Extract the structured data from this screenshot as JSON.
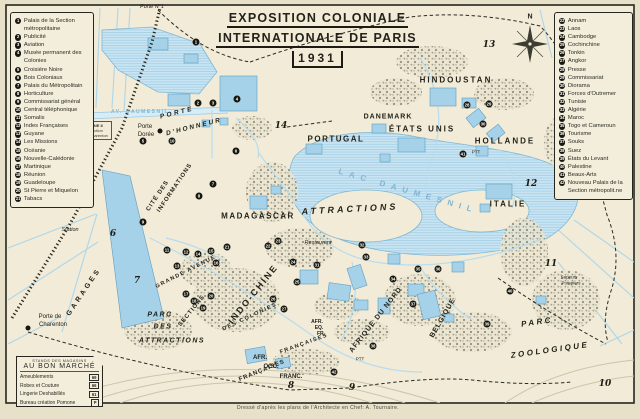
{
  "title": {
    "line1": "EXPOSITION COLONIALE",
    "line2": "INTERNATIONALE DE PARIS",
    "line3": "1931"
  },
  "attribution": "Dressé d'après les plans de l'Architecte en Chef: A. Tournaire.",
  "colors": {
    "paper": "#f1ebd7",
    "water": "#c9e4f2",
    "building": "#a5d1e9",
    "ink": "#23231c"
  },
  "legend_left": {
    "items": [
      {
        "num": "1",
        "label": "Palais de la Section métropolitaine"
      },
      {
        "num": "2",
        "label": "Publicité"
      },
      {
        "num": "3",
        "label": "Aviation"
      },
      {
        "num": "4",
        "label": "Musée permanent des Colonies"
      },
      {
        "num": "5",
        "label": "Croisière Noire"
      },
      {
        "num": "6",
        "label": "Bois Coloniaux"
      },
      {
        "num": "7",
        "label": "Palais du Métropolitain"
      },
      {
        "num": "8",
        "label": "Horticulture"
      },
      {
        "num": "9",
        "label": "Commissariat général"
      },
      {
        "num": "10",
        "label": "Central téléphonique"
      },
      {
        "num": "11",
        "label": "Somalis"
      },
      {
        "num": "12",
        "label": "Indes Françaises"
      },
      {
        "num": "13",
        "label": "Guyane"
      },
      {
        "num": "14",
        "label": "Les Missions"
      },
      {
        "num": "15",
        "label": "Océanie"
      },
      {
        "num": "16",
        "label": "Nouvelle-Calédonie"
      },
      {
        "num": "17",
        "label": "Martinique"
      },
      {
        "num": "18",
        "label": "Réunion"
      },
      {
        "num": "19",
        "label": "Guadeloupe"
      },
      {
        "num": "20",
        "label": "St Pierre et Miquelon"
      },
      {
        "num": "21",
        "label": "Tabacs"
      }
    ]
  },
  "legend_right": {
    "items": [
      {
        "num": "22",
        "label": "Annam"
      },
      {
        "num": "23",
        "label": "Laos"
      },
      {
        "num": "24",
        "label": "Cambodge"
      },
      {
        "num": "25",
        "label": "Cochinchine"
      },
      {
        "num": "26",
        "label": "Tonkin"
      },
      {
        "num": "27",
        "label": "Angkor"
      },
      {
        "num": "28",
        "label": "Presse"
      },
      {
        "num": "29",
        "label": "Commissariat"
      },
      {
        "num": "30",
        "label": "Diorama"
      },
      {
        "num": "31",
        "label": "Forces d'Outremer"
      },
      {
        "num": "32",
        "label": "Tunisie"
      },
      {
        "num": "33",
        "label": "Algérie"
      },
      {
        "num": "34",
        "label": "Maroc"
      },
      {
        "num": "35",
        "label": "Togo et Cameroun"
      },
      {
        "num": "36",
        "label": "Tourisme"
      },
      {
        "num": "37",
        "label": "Souks"
      },
      {
        "num": "38",
        "label": "Suez"
      },
      {
        "num": "39",
        "label": "États du Levant"
      },
      {
        "num": "40",
        "label": "Palestine"
      },
      {
        "num": "41",
        "label": "Beaux-Arts"
      },
      {
        "num": "42",
        "label": "Nouveau Palais de la Section métropolit.ne"
      }
    ]
  },
  "bon_marche": {
    "header_small": "STANDS DES MAGASINS",
    "header": "AU BON MARCHÉ",
    "rows": [
      {
        "label": "Ameublements",
        "badge": "69"
      },
      {
        "label": "Robes et Couture",
        "badge": "66"
      },
      {
        "label": "Lingerie Deshabillés",
        "badge": "61"
      },
      {
        "label": "Bureau création Pomone",
        "badge": "P"
      }
    ]
  },
  "metro_box": {
    "lines": [
      "LIGNE 8",
      "Direction",
      "Pte Charenton"
    ]
  },
  "map_labels": [
    {
      "text": "Porte N°1",
      "x": 152,
      "y": 7,
      "size": 5.5,
      "cls": "it light"
    },
    {
      "text": "AV. DAUMESNIL",
      "x": 140,
      "y": 112,
      "size": 5,
      "ls": 1.5,
      "cls": "blue"
    },
    {
      "text": "PORTE",
      "x": 177,
      "y": 113,
      "rot": -14,
      "size": 6.5,
      "ls": 2.5,
      "cls": "it"
    },
    {
      "text": "D'HONNEUR",
      "x": 194,
      "y": 127,
      "rot": -14,
      "size": 6.5,
      "ls": 2,
      "cls": "it"
    },
    {
      "text": "Porte",
      "x": 145,
      "y": 127,
      "size": 6,
      "cls": "light"
    },
    {
      "text": "Dorée",
      "x": 146,
      "y": 135,
      "size": 6,
      "cls": "light"
    },
    {
      "text": "CITÉ DES",
      "x": 158,
      "y": 196,
      "rot": -56,
      "size": 6,
      "ls": 1
    },
    {
      "text": "INFORMATIONS",
      "x": 175,
      "y": 188,
      "rot": -56,
      "size": 6,
      "ls": 1
    },
    {
      "text": "MADAGASCAR",
      "x": 258,
      "y": 216,
      "size": 8,
      "ls": 1.5
    },
    {
      "text": "PORTUGAL",
      "x": 336,
      "y": 139,
      "size": 8,
      "ls": 1.5
    },
    {
      "text": "DANEMARK",
      "x": 388,
      "y": 117,
      "size": 7,
      "ls": 1
    },
    {
      "text": "ÉTATS UNIS",
      "x": 422,
      "y": 129,
      "size": 8,
      "ls": 2
    },
    {
      "text": "HINDOUSTAN",
      "x": 456,
      "y": 80,
      "size": 8,
      "ls": 2
    },
    {
      "text": "HOLLANDE",
      "x": 505,
      "y": 141,
      "size": 8,
      "ls": 2
    },
    {
      "text": "ITALIE",
      "x": 508,
      "y": 204,
      "size": 8,
      "ls": 2
    },
    {
      "text": "LAC DAUMESNIL",
      "x": 408,
      "y": 191,
      "rot": 16,
      "size": 8,
      "ls": 6,
      "cls": "blue"
    },
    {
      "text": "ATTRACTIONS",
      "x": 350,
      "y": 209,
      "rot": -3,
      "size": 9,
      "ls": 3,
      "cls": "it"
    },
    {
      "text": "Restaurant",
      "x": 318,
      "y": 243,
      "size": 5.5,
      "cls": "it light"
    },
    {
      "text": "GRANDE AVENUE",
      "x": 186,
      "y": 272,
      "rot": -27,
      "size": 5.5,
      "ls": 1.5
    },
    {
      "text": "DES COLONIES",
      "x": 250,
      "y": 317,
      "rot": -25,
      "size": 5.5,
      "ls": 1.5
    },
    {
      "text": "FRANÇAISES",
      "x": 304,
      "y": 344,
      "rot": -20,
      "size": 5.5,
      "ls": 1.5
    },
    {
      "text": "INDO-CHINE",
      "x": 253,
      "y": 294,
      "rot": -51,
      "size": 9,
      "ls": 2
    },
    {
      "text": "SECTIONS",
      "x": 192,
      "y": 311,
      "rot": -51,
      "size": 6,
      "ls": 1
    },
    {
      "text": "PARC",
      "x": 160,
      "y": 315,
      "size": 7,
      "ls": 1.5,
      "cls": "it"
    },
    {
      "text": "DES",
      "x": 163,
      "y": 327,
      "size": 7,
      "ls": 1.5,
      "cls": "it"
    },
    {
      "text": "ATTRACTIONS",
      "x": 172,
      "y": 341,
      "size": 7,
      "ls": 1.5,
      "cls": "it"
    },
    {
      "text": "AFRIQUE DU NORD",
      "x": 376,
      "y": 320,
      "rot": -52,
      "size": 7,
      "ls": 1
    },
    {
      "text": "BELGIQUE",
      "x": 443,
      "y": 318,
      "rot": -60,
      "size": 7,
      "ls": 1
    },
    {
      "text": "PARC",
      "x": 537,
      "y": 322,
      "rot": -8,
      "size": 8,
      "ls": 2.5,
      "cls": "it"
    },
    {
      "text": "ZOOLOGIQUE",
      "x": 550,
      "y": 350,
      "rot": -8,
      "size": 8,
      "ls": 2.5,
      "cls": "it"
    },
    {
      "text": "AFR.",
      "x": 317,
      "y": 322,
      "size": 5
    },
    {
      "text": "EQ.",
      "x": 319,
      "y": 328,
      "size": 5
    },
    {
      "text": "FR.",
      "x": 321,
      "y": 334,
      "size": 5
    },
    {
      "text": "AFR.",
      "x": 260,
      "y": 358,
      "size": 6
    },
    {
      "text": "OCC.",
      "x": 271,
      "y": 367,
      "size": 6
    },
    {
      "text": "FRANC.",
      "x": 291,
      "y": 377,
      "size": 6
    },
    {
      "text": "FRANÇAISES",
      "x": 262,
      "y": 371,
      "rot": -22,
      "size": 6,
      "ls": 1
    },
    {
      "text": "GARAGES",
      "x": 84,
      "y": 292,
      "rot": -56,
      "size": 7,
      "ls": 3
    },
    {
      "text": "Station",
      "x": 70,
      "y": 230,
      "size": 5.5,
      "cls": "it light"
    },
    {
      "text": "Porte de",
      "x": 50,
      "y": 317,
      "size": 6,
      "cls": "light"
    },
    {
      "text": "Charenton",
      "x": 53,
      "y": 325,
      "size": 6,
      "cls": "light"
    },
    {
      "text": "Sapeurs",
      "x": 569,
      "y": 277,
      "size": 4.5,
      "cls": "light"
    },
    {
      "text": "Pompiers",
      "x": 571,
      "y": 283,
      "size": 4.5,
      "cls": "light"
    },
    {
      "text": "PTT",
      "x": 476,
      "y": 152,
      "size": 4.5,
      "cls": "light"
    },
    {
      "text": "PTT",
      "x": 360,
      "y": 359,
      "size": 4.5,
      "cls": "light"
    },
    {
      "text": "N",
      "x": 530,
      "y": 17,
      "size": 7
    },
    {
      "text": "6",
      "x": 113,
      "y": 234,
      "size": 9,
      "cls": "gate"
    },
    {
      "text": "7",
      "x": 137,
      "y": 281,
      "size": 9,
      "cls": "gate"
    },
    {
      "text": "8",
      "x": 291,
      "y": 386,
      "size": 9,
      "cls": "gate"
    },
    {
      "text": "9",
      "x": 352,
      "y": 388,
      "size": 9,
      "cls": "gate"
    },
    {
      "text": "10",
      "x": 605,
      "y": 384,
      "size": 9,
      "cls": "gate"
    },
    {
      "text": "11",
      "x": 551,
      "y": 264,
      "size": 9,
      "cls": "gate"
    },
    {
      "text": "12",
      "x": 531,
      "y": 184,
      "size": 9,
      "cls": "gate"
    },
    {
      "text": "13",
      "x": 489,
      "y": 45,
      "size": 9,
      "cls": "gate"
    },
    {
      "text": "14",
      "x": 281,
      "y": 126,
      "size": 9,
      "cls": "gate"
    }
  ],
  "markers": [
    {
      "n": "1",
      "x": 196,
      "y": 42
    },
    {
      "n": "2",
      "x": 198,
      "y": 103
    },
    {
      "n": "3",
      "x": 213,
      "y": 103
    },
    {
      "n": "4",
      "x": 237,
      "y": 99
    },
    {
      "n": "5",
      "x": 143,
      "y": 141
    },
    {
      "n": "6",
      "x": 236,
      "y": 151
    },
    {
      "n": "7",
      "x": 213,
      "y": 184
    },
    {
      "n": "8",
      "x": 199,
      "y": 196
    },
    {
      "n": "9",
      "x": 143,
      "y": 222
    },
    {
      "n": "10",
      "x": 172,
      "y": 141
    },
    {
      "n": "11",
      "x": 167,
      "y": 250
    },
    {
      "n": "12",
      "x": 186,
      "y": 252
    },
    {
      "n": "13",
      "x": 177,
      "y": 266
    },
    {
      "n": "14",
      "x": 198,
      "y": 254
    },
    {
      "n": "15",
      "x": 211,
      "y": 251
    },
    {
      "n": "16",
      "x": 216,
      "y": 263
    },
    {
      "n": "17",
      "x": 186,
      "y": 294
    },
    {
      "n": "18",
      "x": 194,
      "y": 301
    },
    {
      "n": "19",
      "x": 203,
      "y": 308
    },
    {
      "n": "20",
      "x": 211,
      "y": 296
    },
    {
      "n": "21",
      "x": 227,
      "y": 247
    },
    {
      "n": "22",
      "x": 268,
      "y": 246
    },
    {
      "n": "23",
      "x": 278,
      "y": 241
    },
    {
      "n": "24",
      "x": 293,
      "y": 262
    },
    {
      "n": "25",
      "x": 297,
      "y": 282
    },
    {
      "n": "26",
      "x": 273,
      "y": 299
    },
    {
      "n": "27",
      "x": 284,
      "y": 309
    },
    {
      "n": "28",
      "x": 467,
      "y": 105
    },
    {
      "n": "29",
      "x": 489,
      "y": 104
    },
    {
      "n": "30",
      "x": 483,
      "y": 124
    },
    {
      "n": "31",
      "x": 317,
      "y": 265
    },
    {
      "n": "32",
      "x": 362,
      "y": 245
    },
    {
      "n": "33",
      "x": 366,
      "y": 257
    },
    {
      "n": "34",
      "x": 393,
      "y": 279
    },
    {
      "n": "35",
      "x": 418,
      "y": 269
    },
    {
      "n": "36",
      "x": 438,
      "y": 269
    },
    {
      "n": "37",
      "x": 413,
      "y": 304
    },
    {
      "n": "38",
      "x": 373,
      "y": 346
    },
    {
      "n": "39",
      "x": 487,
      "y": 324
    },
    {
      "n": "40",
      "x": 510,
      "y": 291
    },
    {
      "n": "41",
      "x": 463,
      "y": 154
    },
    {
      "n": "42",
      "x": 334,
      "y": 372
    }
  ]
}
